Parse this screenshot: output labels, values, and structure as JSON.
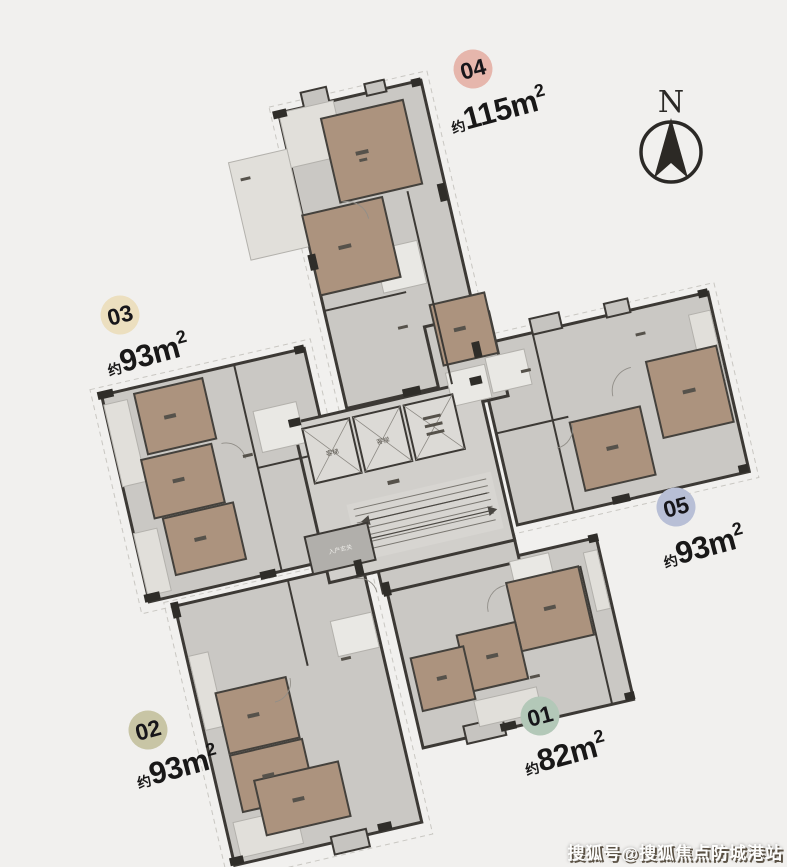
{
  "page": {
    "background": "#f1f0ee"
  },
  "compass": {
    "label": "N"
  },
  "watermark": {
    "text": "搜狐号@搜狐焦点防城港站"
  },
  "floor_plan": {
    "core": {
      "elevator_label": "客梯",
      "entry_label": "入户玄关"
    },
    "units": [
      {
        "id": "01",
        "area_prefix": "约",
        "area_value": "82",
        "area_unit": "m",
        "area_sup": "2",
        "badge_color": "#b3c8b8"
      },
      {
        "id": "02",
        "area_prefix": "约",
        "area_value": "93",
        "area_unit": "m",
        "area_sup": "2",
        "badge_color": "#c8c5a5"
      },
      {
        "id": "03",
        "area_prefix": "约",
        "area_value": "93",
        "area_unit": "m",
        "area_sup": "2",
        "badge_color": "#ecdfbf"
      },
      {
        "id": "04",
        "area_prefix": "约",
        "area_value": "115",
        "area_unit": "m",
        "area_sup": "2",
        "badge_color": "#e6b6ac"
      },
      {
        "id": "05",
        "area_prefix": "约",
        "area_value": "93",
        "area_unit": "m",
        "area_sup": "2",
        "badge_color": "#b8bfd6"
      }
    ],
    "colors": {
      "walls": "#3c3935",
      "floor_gray": "#cac8c4",
      "room_brown": "#ac937e",
      "floor_light": "#e1dfda",
      "core_gray": "#d1cfcb"
    }
  }
}
